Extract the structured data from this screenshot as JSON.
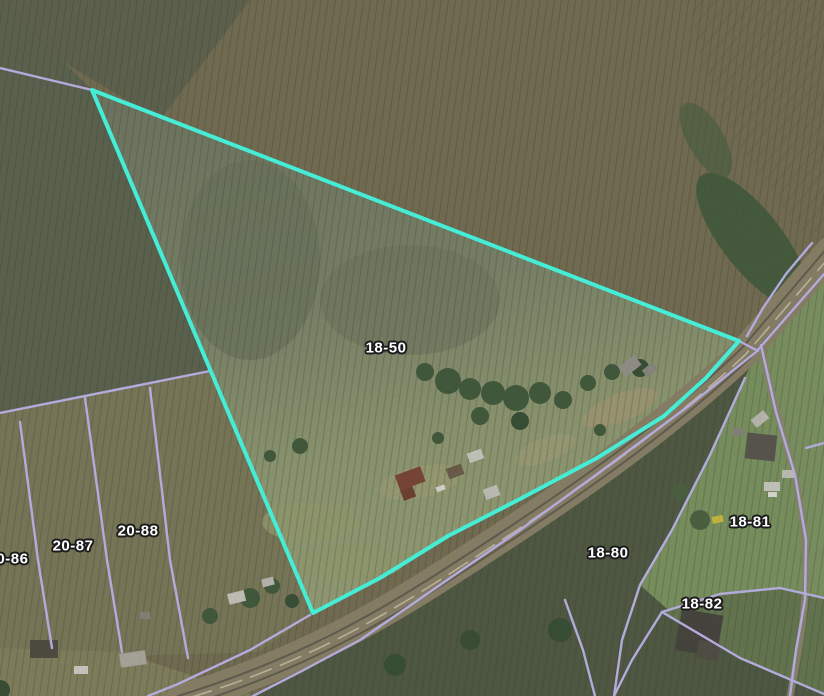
{
  "map": {
    "type": "aerial-parcel-viewer",
    "highlighted_parcel": {
      "id": "18-50",
      "outline_color": "#45EDD6",
      "outline_width": 4,
      "points": "92,90 739,341 706,378 664,416 597,458 520,499 448,536 380,578 313,613"
    },
    "parcel_line_color": "#B3ABDC",
    "parcel_line_width": 2.4,
    "parcel_lines": [
      {
        "name": "northwest-boundary",
        "points": "0,68 92,90"
      },
      {
        "name": "block-20-north-boundary",
        "points": "0,413 210,371"
      },
      {
        "name": "line-20-86-20-87",
        "points": "20,422 38,560 52,648"
      },
      {
        "name": "line-20-87-20-88",
        "points": "85,398 107,560 122,652"
      },
      {
        "name": "line-20-88-east",
        "points": "150,388 170,560 188,658"
      },
      {
        "name": "road-northeast-edge-upper",
        "points": "812,243 786,274 763,308 747,336"
      },
      {
        "name": "road-northeast-edge-lower",
        "points": "310,615 250,650 178,684 148,696"
      },
      {
        "name": "road-southwest-edge",
        "points": "824,274 756,352 690,405 600,472 520,530 440,585 360,640 300,672 253,696"
      },
      {
        "name": "driveway-east-boundary",
        "points": "761,345 776,412 795,475 806,540 805,600 796,650 790,696"
      },
      {
        "name": "line-18-80-18-81",
        "points": "745,378 710,455 672,530 640,585 622,640 614,696"
      },
      {
        "name": "line-18-82-west-v",
        "points": "614,696 632,660 662,612"
      },
      {
        "name": "line-18-81-18-82",
        "points": "662,612 720,594 780,588 824,598"
      },
      {
        "name": "line-18-82-south",
        "points": "662,612 740,658 824,694"
      },
      {
        "name": "right-edge-spur",
        "points": "806,448 824,443"
      },
      {
        "name": "line-18-80-south-branch",
        "points": "565,600 583,650 595,696"
      },
      {
        "name": "road-crossing-at-vertex",
        "points": "739,341 758,351"
      }
    ],
    "labels": [
      {
        "text": "18-50",
        "x": 386,
        "y": 348
      },
      {
        "text": "20-86",
        "x": 8,
        "y": 559
      },
      {
        "text": "20-87",
        "x": 73,
        "y": 546
      },
      {
        "text": "20-88",
        "x": 138,
        "y": 531
      },
      {
        "text": "18-80",
        "x": 608,
        "y": 553
      },
      {
        "text": "18-81",
        "x": 750,
        "y": 522
      },
      {
        "text": "18-82",
        "x": 702,
        "y": 604
      }
    ],
    "label_text_color": "#FFFFFF",
    "label_outline_color": "#1C1C1C"
  }
}
